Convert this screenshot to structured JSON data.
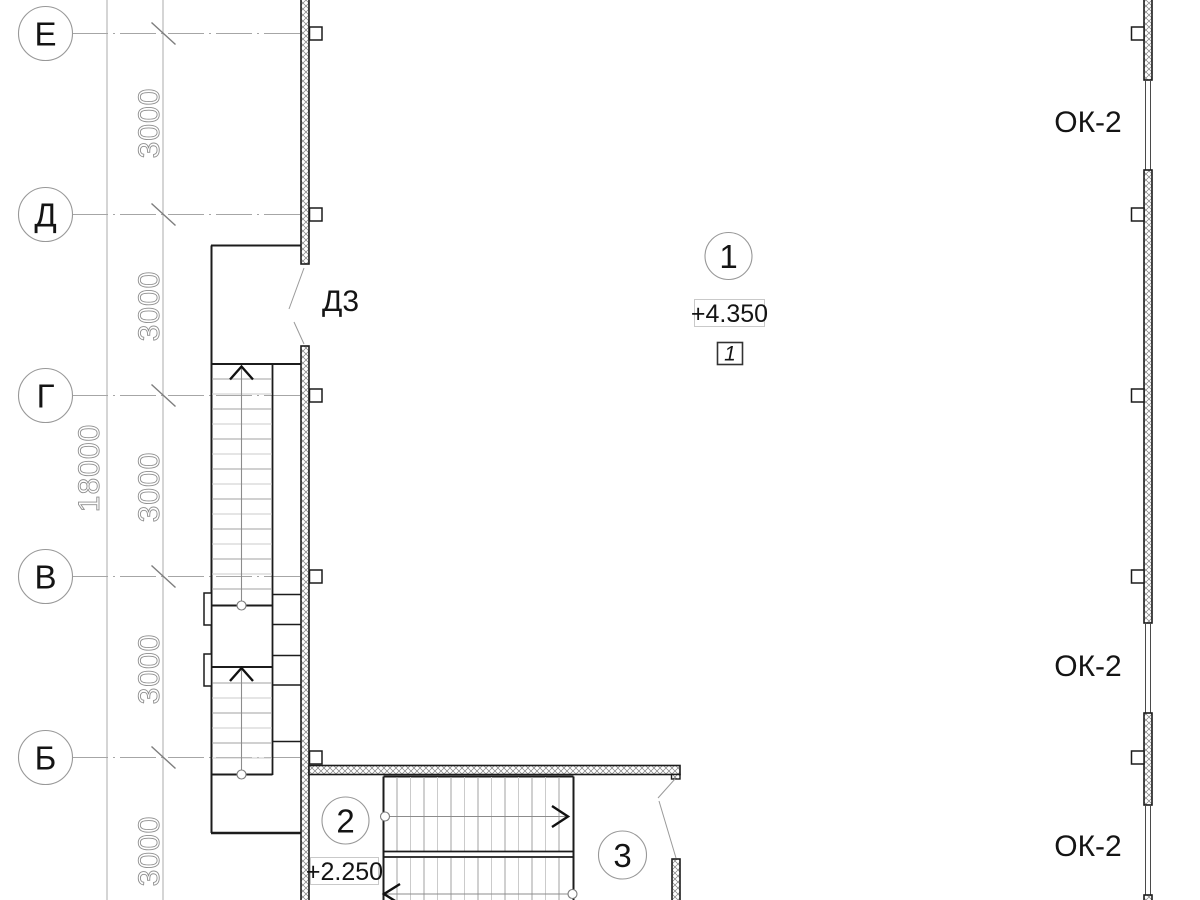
{
  "grid": {
    "axes": [
      {
        "label": "Е"
      },
      {
        "label": "Д"
      },
      {
        "label": "Г"
      },
      {
        "label": "В"
      },
      {
        "label": "Б"
      }
    ],
    "bays": [
      "3000",
      "3000",
      "3000",
      "3000",
      "3000"
    ],
    "overall": "18000"
  },
  "labels": {
    "position_circles": [
      "1",
      "2",
      "3"
    ],
    "elevations": [
      "+4.350",
      "+2.250"
    ],
    "stair_number": "1",
    "door": "Д3",
    "windows": [
      "ОК-2",
      "ОК-2",
      "ОК-2"
    ]
  },
  "colors": {
    "background": "#ffffff",
    "dark_line": "#1c1c1c",
    "grid_line": "#a6a6a6",
    "dim_text_outline": "#8f8f8f",
    "text": "#141414"
  }
}
